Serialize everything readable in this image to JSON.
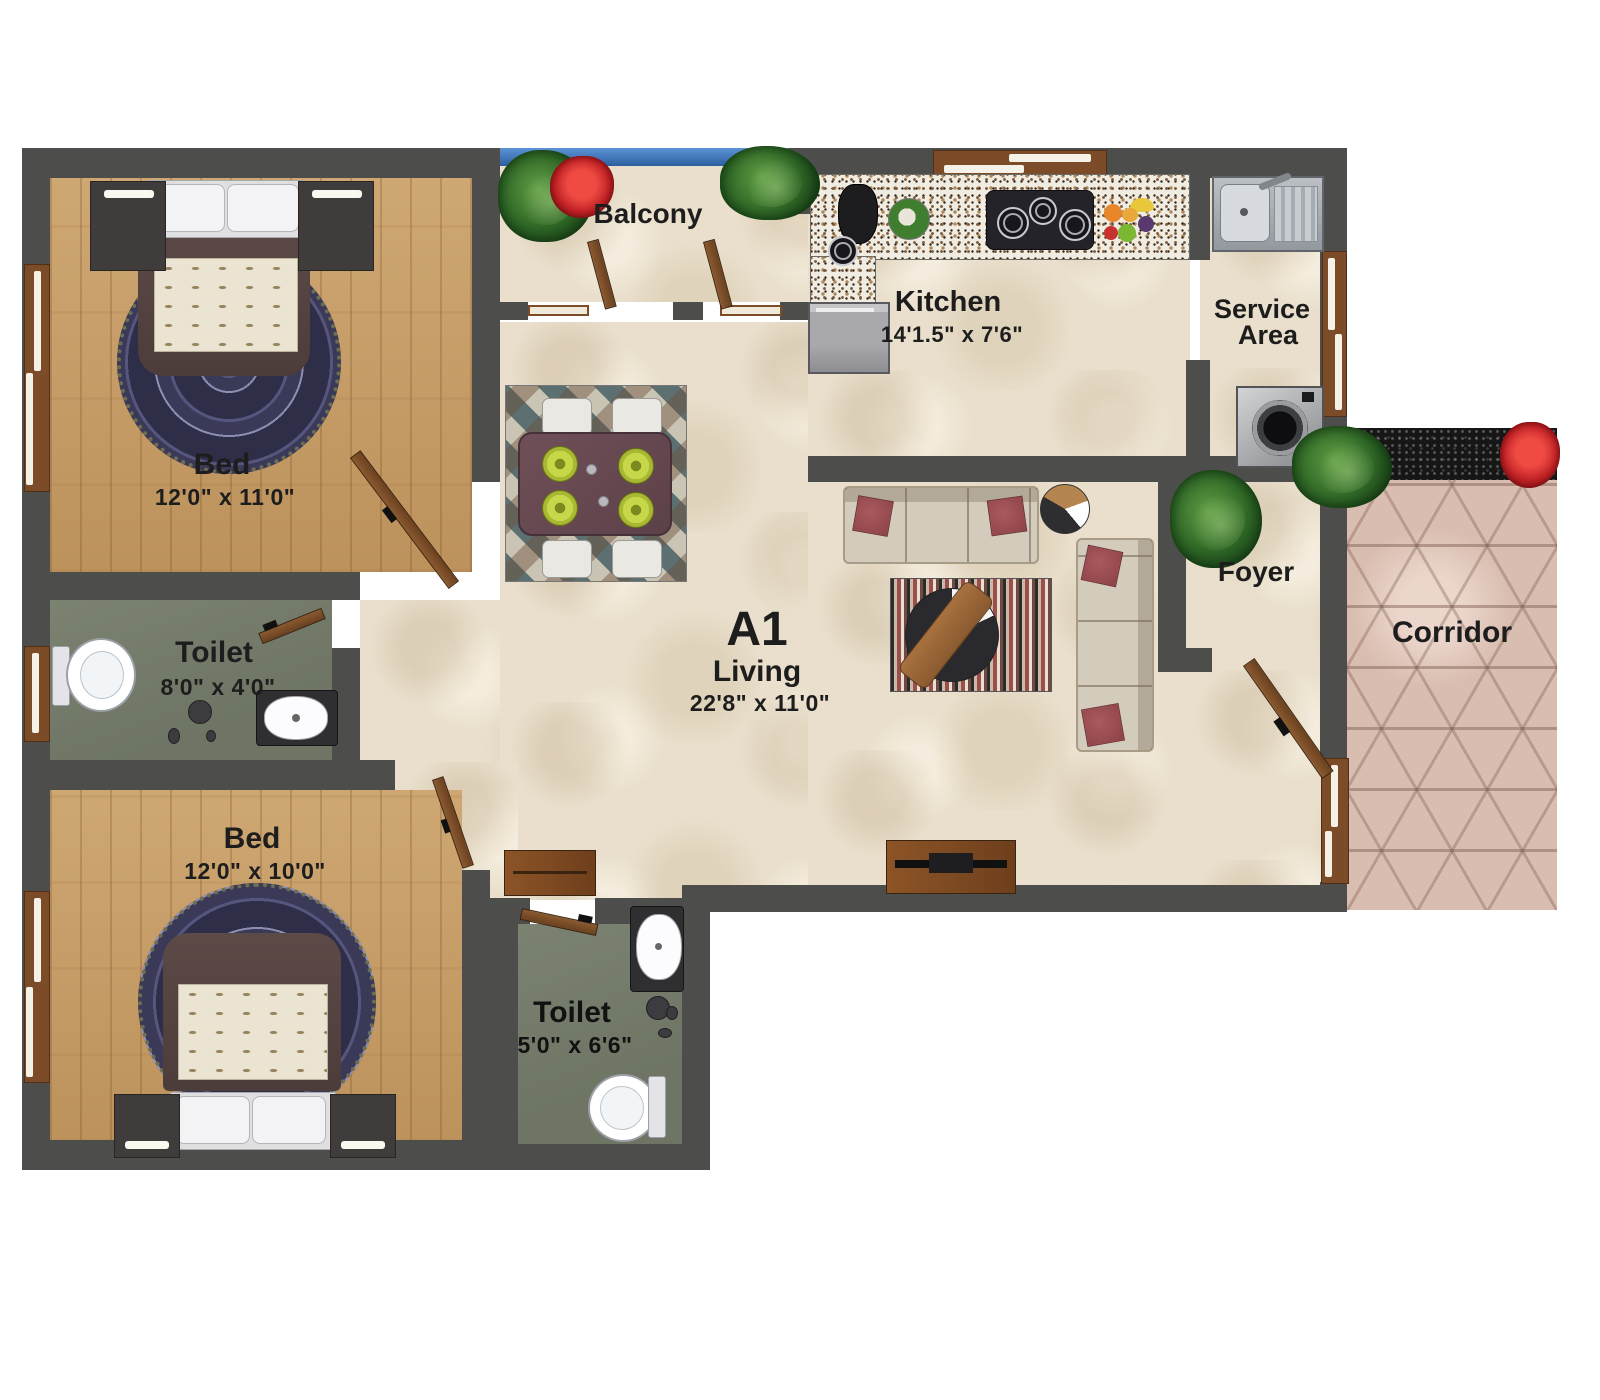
{
  "unit": {
    "label": "A1"
  },
  "rooms": {
    "balcony": {
      "label": "Balcony"
    },
    "kitchen": {
      "label": "Kitchen",
      "dims": "14'1.5\" x 7'6\""
    },
    "service_area": {
      "line1": "Service",
      "line2": "Area"
    },
    "living": {
      "label": "Living",
      "dims": "22'8\" x 11'0\""
    },
    "foyer": {
      "label": "Foyer"
    },
    "corridor": {
      "label": "Corridor"
    },
    "bedroom_top": {
      "label": "Bed",
      "dims": "12'0\" x 11'0\""
    },
    "bedroom_bottom": {
      "label": "Bed",
      "dims": "12'0\" x 10'0\""
    },
    "toilet_top": {
      "label": "Toilet",
      "dims": "8'0\" x 4'0\""
    },
    "toilet_bottom": {
      "label": "Toilet",
      "dims": "5'0\" x 6'6\""
    }
  },
  "colors": {
    "wall": "#4d4d4b",
    "wood_floor": "#c69b63",
    "tile_floor": "#e9dfcc",
    "toilet_floor": "#747b6b",
    "corridor_floor": "#d9bdb0",
    "railing_blue": "#3d79c0",
    "door_wood": "#7c4b28",
    "label_text": "#1d1d1d"
  }
}
